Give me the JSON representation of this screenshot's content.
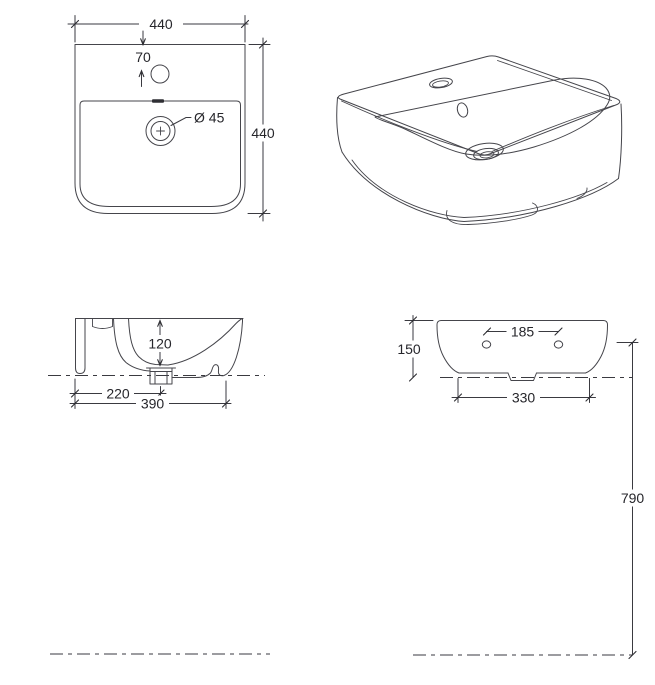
{
  "drawing": {
    "labels": {
      "plan_width": "440",
      "plan_depth": "440",
      "faucet_offset": "70",
      "drain_diameter": "Ø 45",
      "bowl_depth": "120",
      "drain_offset": "220",
      "overall_depth": "390",
      "hole_spacing": "185",
      "body_height": "150",
      "base_width": "330",
      "mounting_height": "790"
    },
    "colors": {
      "line": "#45454b",
      "text": "#26262b",
      "background": "#ffffff"
    }
  }
}
